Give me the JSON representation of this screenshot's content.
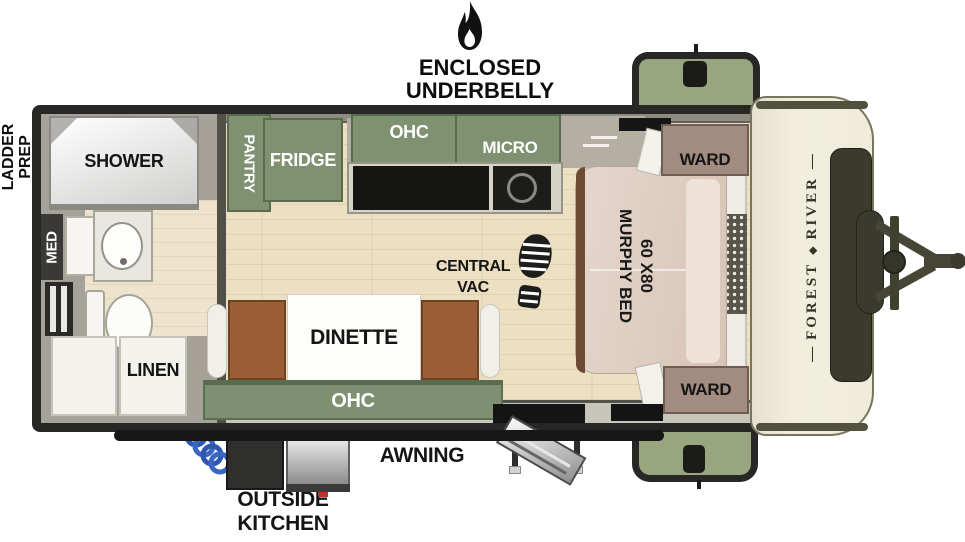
{
  "underbelly": {
    "line1": "ENCLOSED UNDERBELLY",
    "line2": "W/ FORCED HEAT"
  },
  "ladder_prep": {
    "line1": "LADDER",
    "line2": "PREP"
  },
  "bathroom": {
    "shower": "SHOWER",
    "med": "MED",
    "linen": "LINEN"
  },
  "kitchen": {
    "pantry": "PANTRY",
    "fridge": "FRIDGE",
    "ohc": "OHC",
    "micro": "MICRO"
  },
  "living": {
    "central_vac_line1": "CENTRAL",
    "central_vac_line2": "VAC",
    "dinette": "DINETTE",
    "dinette_ohc": "OHC"
  },
  "bedroom": {
    "bed_size": "60 X80",
    "bed_name": "MURPHY BED",
    "ward_top": "WARD",
    "ward_bottom": "WARD"
  },
  "exterior": {
    "awning": "AWNING",
    "outside_kitchen_line1": "OUTSIDE",
    "outside_kitchen_line2": "KITCHEN",
    "brand_first": "FOREST",
    "brand_second": "RIVER"
  },
  "colors": {
    "cabinet_green": "#7f9171",
    "storage_green": "#99a57f",
    "floor_wood": "#ecdfc2",
    "bed_tan": "#e0cec2",
    "ward_taupe": "#a28b7f",
    "frame_black": "#272725",
    "cap_cream": "#efecdb",
    "hose_blue": "#3a66c4",
    "seat_brown": "#9a5e36"
  }
}
